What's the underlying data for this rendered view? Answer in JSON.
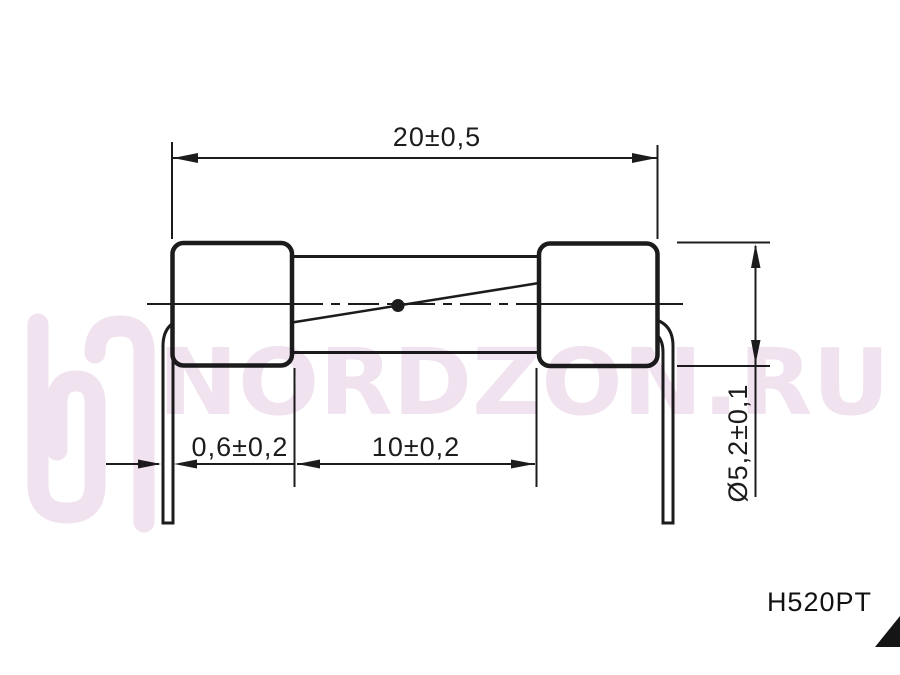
{
  "drawing": {
    "title": "fuse-with-radial-leads-dimension-drawing",
    "dim_total_length": "20±0,5",
    "dim_lead_diameter": "0,6±0,2",
    "dim_body_length": "10±0,2",
    "dim_cap_diameter": "Ø5,2±0,1",
    "part_number": "H520PT"
  },
  "watermark": {
    "logo_icon": "nordzon-logo",
    "text": "NORDZON.RU",
    "color": "#f0e2ee"
  },
  "colors": {
    "line": "#1c1c1c",
    "background": "#ffffff",
    "watermark": "#f0e2ee"
  }
}
